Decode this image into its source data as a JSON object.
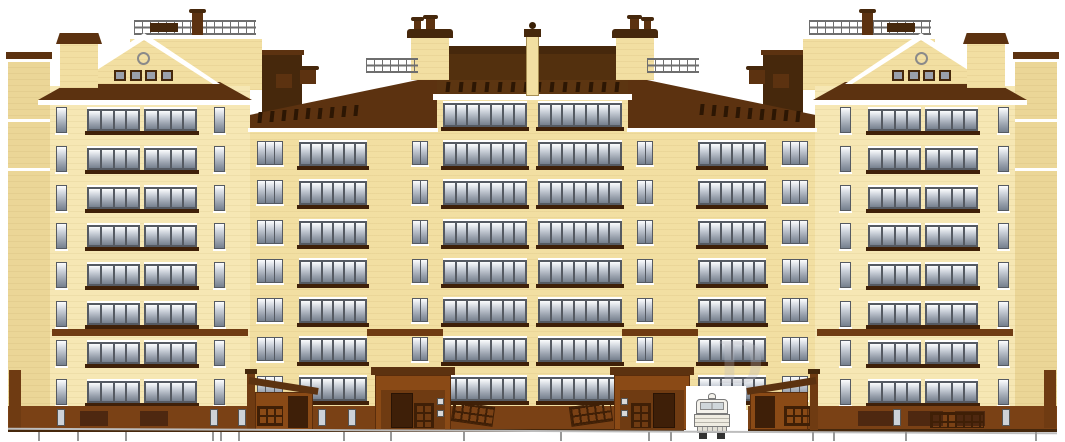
{
  "document": {
    "type": "architectural elevation drawing",
    "subject": "Multi-storey residential apartment building, main facade",
    "background": "#ffffff"
  },
  "colors": {
    "wall": "#F2DFA2",
    "wall_light": "#F6E7B4",
    "wall_shade": "#EBD697",
    "cornice_white": "#FFFFFF",
    "roof_brown": "#5C3210",
    "roof_dark": "#46280C",
    "attic_slit": "#2C1603",
    "glass_top": "#FCFDFE",
    "glass_mid": "#C9CFD8",
    "glass_bottom": "#76808E",
    "window_frame": "#555A62",
    "balcony_slab": "#3F2008",
    "belt_course": "#6F3B12",
    "plinth": "#7A4115",
    "plinth_recess": "#4E2810",
    "porch": "#8A4A16",
    "porch_dark": "#6F3B12",
    "door": "#3E1F08",
    "lattice": "#3F1F06",
    "railing_gray": "#6E6E6E",
    "ground_line": "#BDBDBD",
    "tick": "#999999"
  },
  "building": {
    "towers": {
      "count": 2,
      "floors": 8,
      "balcony_panels_per_floor": 2,
      "panes_per_panel": 4,
      "narrow_window_columns": 2,
      "pediment": {
        "oculus": true,
        "attic_windows": 4
      },
      "roof_deck": {
        "railing": true,
        "chimney": true,
        "hatch": true
      }
    },
    "center_block": {
      "floors": 8,
      "balcony_bands_per_floor": 2,
      "panes_per_band": 7,
      "pier_window_floors": 7,
      "mansard_vent_slits": 14,
      "roof_flagpole": true,
      "roof_bulkheads": 2,
      "roof_railings": 2
    },
    "wings": {
      "count": 2,
      "floors": 7,
      "balcony_panes": 6,
      "triple_window_floors": 7,
      "roof_vent_slits": 9,
      "roof_chimneys_per_wing": 2
    },
    "entrances": {
      "count": 4,
      "with_intercom_panels": 2,
      "with_ramps": 2,
      "with_canopies": 2
    },
    "basement": {
      "recessed_panels": 5,
      "small_openings": 7
    },
    "passage": {
      "present": true,
      "vehicle_clearance_drawing": "truck front view"
    }
  },
  "ground": {
    "tick_marks": 16
  },
  "watermark": {
    "text": "D"
  }
}
